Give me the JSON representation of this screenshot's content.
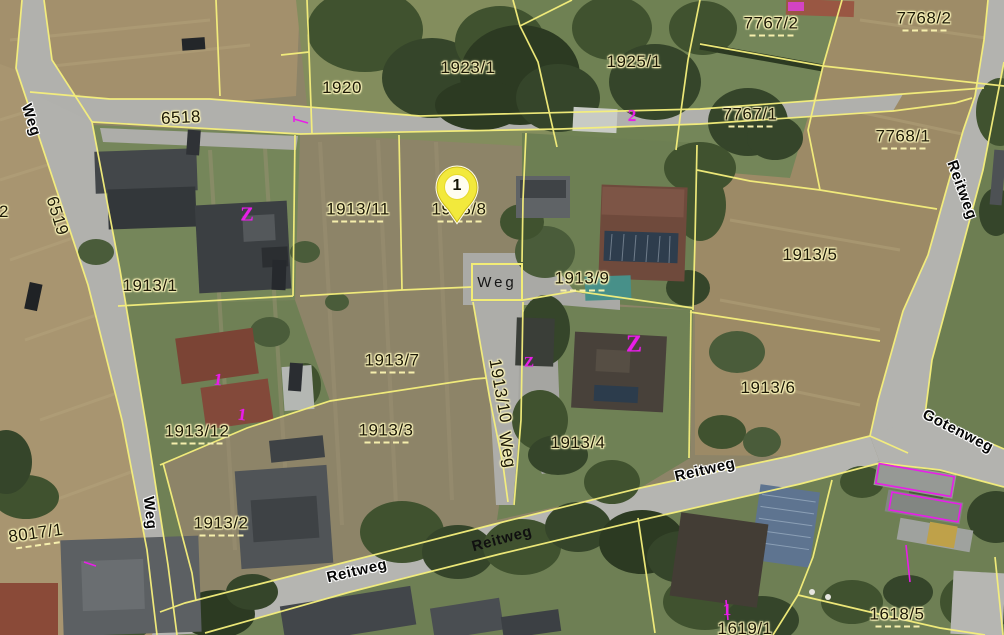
{
  "map": {
    "marker": {
      "label": "1"
    },
    "weg_sign": {
      "text": "Weg"
    },
    "parcel_labels": [
      {
        "t": "6518",
        "x": 181,
        "y": 118,
        "r": -3
      },
      {
        "t": "1920",
        "x": 342,
        "y": 88,
        "r": 0
      },
      {
        "t": "1923/1",
        "x": 468,
        "y": 68,
        "r": 0
      },
      {
        "t": "1925/1",
        "x": 634,
        "y": 62,
        "r": 0
      },
      {
        "t": "7767/2",
        "x": 771,
        "y": 25,
        "r": 0,
        "d": 1
      },
      {
        "t": "7768/2",
        "x": 924,
        "y": 20,
        "r": 0,
        "d": 1
      },
      {
        "t": "7767/1",
        "x": 750,
        "y": 116,
        "r": 0,
        "d": 1
      },
      {
        "t": "7768/1",
        "x": 903,
        "y": 138,
        "r": 0,
        "d": 1
      },
      {
        "t": "6519",
        "x": 57,
        "y": 216,
        "r": 73
      },
      {
        "t": "2",
        "x": 4,
        "y": 212,
        "r": 0
      },
      {
        "t": "1913/1",
        "x": 150,
        "y": 286,
        "r": 0
      },
      {
        "t": "1913/11",
        "x": 358,
        "y": 211,
        "r": 0,
        "d": 1
      },
      {
        "t": "1913/8",
        "x": 459,
        "y": 211,
        "r": 0,
        "d": 1
      },
      {
        "t": "1913/9",
        "x": 582,
        "y": 280,
        "r": 0,
        "d": 1
      },
      {
        "t": "1913/5",
        "x": 810,
        "y": 255,
        "r": 0
      },
      {
        "t": "1913/7",
        "x": 392,
        "y": 362,
        "r": 0,
        "d": 1
      },
      {
        "t": "1913/3",
        "x": 386,
        "y": 432,
        "r": 0,
        "d": 1
      },
      {
        "t": "1913/10",
        "x": 500,
        "y": 391,
        "r": 80
      },
      {
        "t": "Weg",
        "x": 507,
        "y": 450,
        "r": 80
      },
      {
        "t": "1913/4",
        "x": 578,
        "y": 443,
        "r": 0
      },
      {
        "t": "1913/6",
        "x": 768,
        "y": 388,
        "r": 0
      },
      {
        "t": "1913/12",
        "x": 197,
        "y": 433,
        "r": 0,
        "d": 1
      },
      {
        "t": "1913/2",
        "x": 221,
        "y": 525,
        "r": 0,
        "d": 1
      },
      {
        "t": "8017/1",
        "x": 36,
        "y": 535,
        "r": -8,
        "d": 1
      },
      {
        "t": "1618/5",
        "x": 897,
        "y": 616,
        "r": 0,
        "d": 1
      },
      {
        "t": "1619/1",
        "x": 745,
        "y": 629,
        "r": 0
      }
    ],
    "street_labels": [
      {
        "t": "Weg",
        "x": 31,
        "y": 120,
        "r": 72
      },
      {
        "t": "Weg",
        "x": 150,
        "y": 513,
        "r": 84
      },
      {
        "t": "Reitweg",
        "x": 357,
        "y": 571,
        "r": -13
      },
      {
        "t": "Reitweg",
        "x": 502,
        "y": 539,
        "r": -15,
        "plain": 1
      },
      {
        "t": "Reitweg",
        "x": 705,
        "y": 470,
        "r": -13
      },
      {
        "t": "Reitweg",
        "x": 962,
        "y": 190,
        "r": 70
      },
      {
        "t": "Gotenweg",
        "x": 958,
        "y": 431,
        "r": 27
      }
    ],
    "symbols": [
      {
        "t": "Z",
        "x": 247,
        "y": 215,
        "r": 0,
        "s": 20
      },
      {
        "t": "2",
        "x": 632,
        "y": 116,
        "r": 0,
        "s": 17
      },
      {
        "t": "Z",
        "x": 529,
        "y": 363,
        "r": 0,
        "s": 15
      },
      {
        "t": "Z",
        "x": 634,
        "y": 345,
        "r": 0,
        "s": 24
      },
      {
        "t": "1",
        "x": 218,
        "y": 380,
        "r": 8,
        "s": 17
      },
      {
        "t": "1",
        "x": 242,
        "y": 415,
        "r": 8,
        "s": 17
      },
      {
        "t": "1",
        "x": 727,
        "y": 610,
        "r": 0,
        "s": 17
      }
    ],
    "colors": {
      "parcel_line": "#f6f07c",
      "symbol_magenta": "#e81ee8",
      "marker_fill": "#f2e93c",
      "label_halo": "#f8f2b8",
      "street_halo": "#ffffff"
    }
  }
}
